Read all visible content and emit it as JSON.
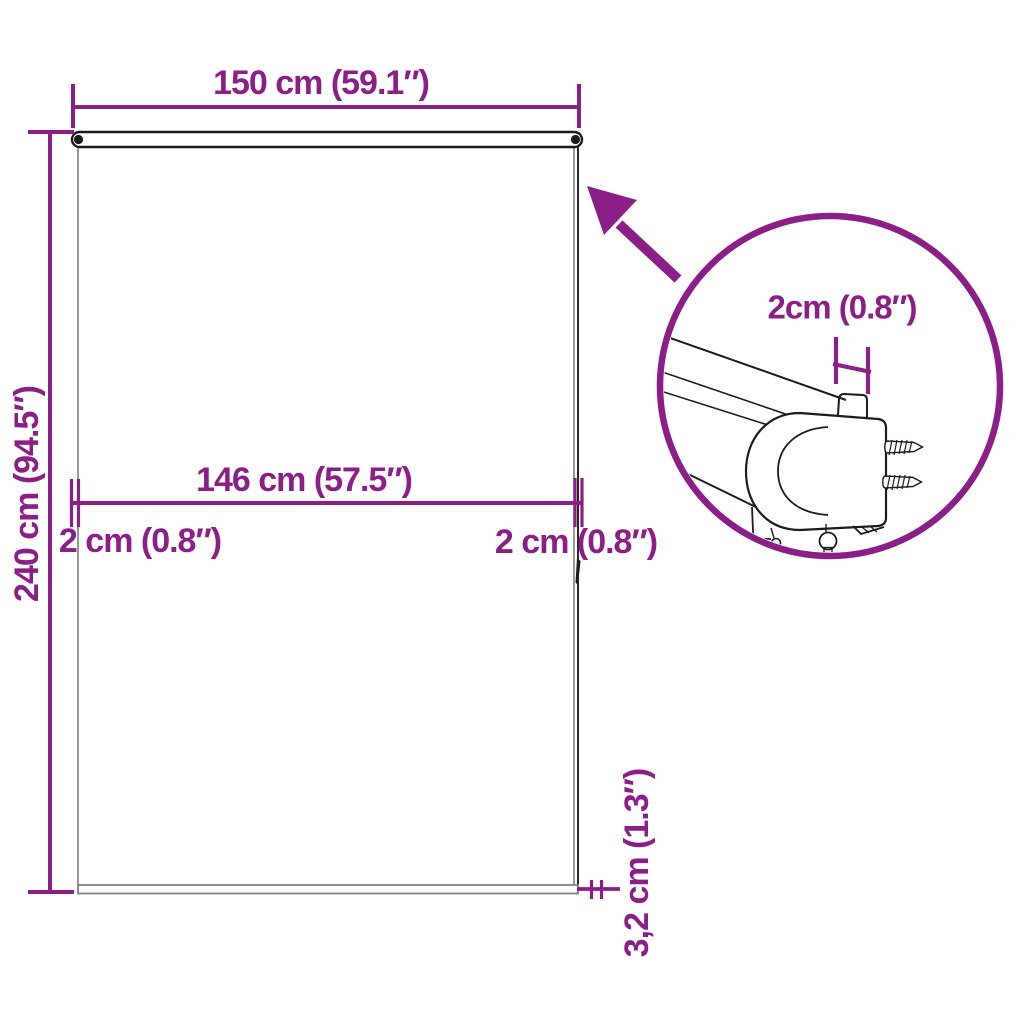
{
  "colors": {
    "accent": "#8B1E87",
    "linework_dark": "#1c1c1c",
    "linework_gray": "#7f7f7f"
  },
  "diagram": {
    "labels": {
      "total_width": "150 cm (59.1″)",
      "total_height": "240 cm (94.5″)",
      "inner_width": "146 cm (57.5″)",
      "gap_left": "2 cm (0.8″)",
      "gap_right": "2 cm (0.8″)",
      "bottom_bar": "3,2 cm (1.3″)",
      "detail_width": "2cm (0.8″)"
    },
    "icons": {
      "callout_arrow": "arrow-pointing-upper-left",
      "detail_circle": "magnified-detail-circle"
    }
  }
}
